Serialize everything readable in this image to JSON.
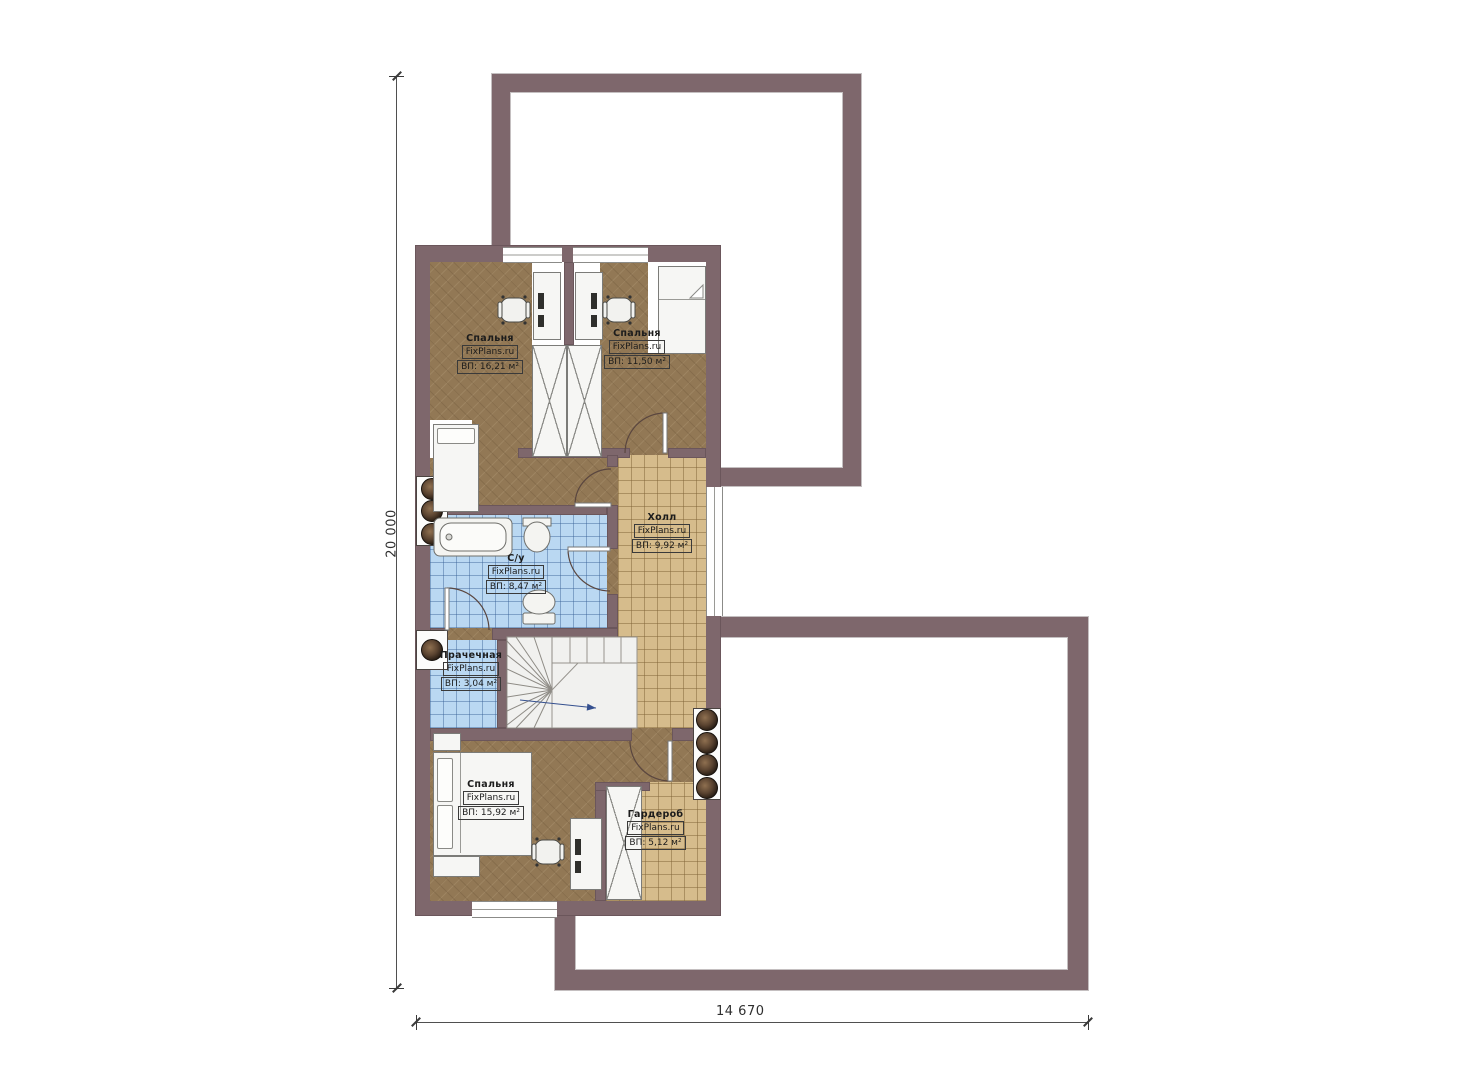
{
  "plan": {
    "brand": "FixPlans.ru",
    "rooms": [
      {
        "key": "bedroom-top-left",
        "name": "Спальня",
        "brand": "FixPlans.ru",
        "area": "ВП: 16,21 м²"
      },
      {
        "key": "bedroom-top-right",
        "name": "Спальня",
        "brand": "FixPlans.ru",
        "area": "ВП: 11,50 м²"
      },
      {
        "key": "hall",
        "name": "Холл",
        "brand": "FixPlans.ru",
        "area": "ВП: 9,92 м²"
      },
      {
        "key": "bathroom",
        "name": "С/у",
        "brand": "FixPlans.ru",
        "area": "ВП: 8,47 м²"
      },
      {
        "key": "laundry",
        "name": "Прачечная",
        "brand": "FixPlans.ru",
        "area": "ВП: 3,04 м²"
      },
      {
        "key": "bedroom-bottom",
        "name": "Спальня",
        "brand": "FixPlans.ru",
        "area": "ВП: 15,92 м²"
      },
      {
        "key": "wardrobe",
        "name": "Гардероб",
        "brand": "FixPlans.ru",
        "area": "ВП: 5,12 м²"
      }
    ],
    "dimensions": {
      "vertical": "20 000",
      "horizontal": "14 670"
    },
    "colors": {
      "wall": "#7e676c",
      "wood_floor": "#927855",
      "tile_beige": "#d6bc8c",
      "tile_blue": "#bad8f2",
      "background": "#ffffff"
    }
  }
}
